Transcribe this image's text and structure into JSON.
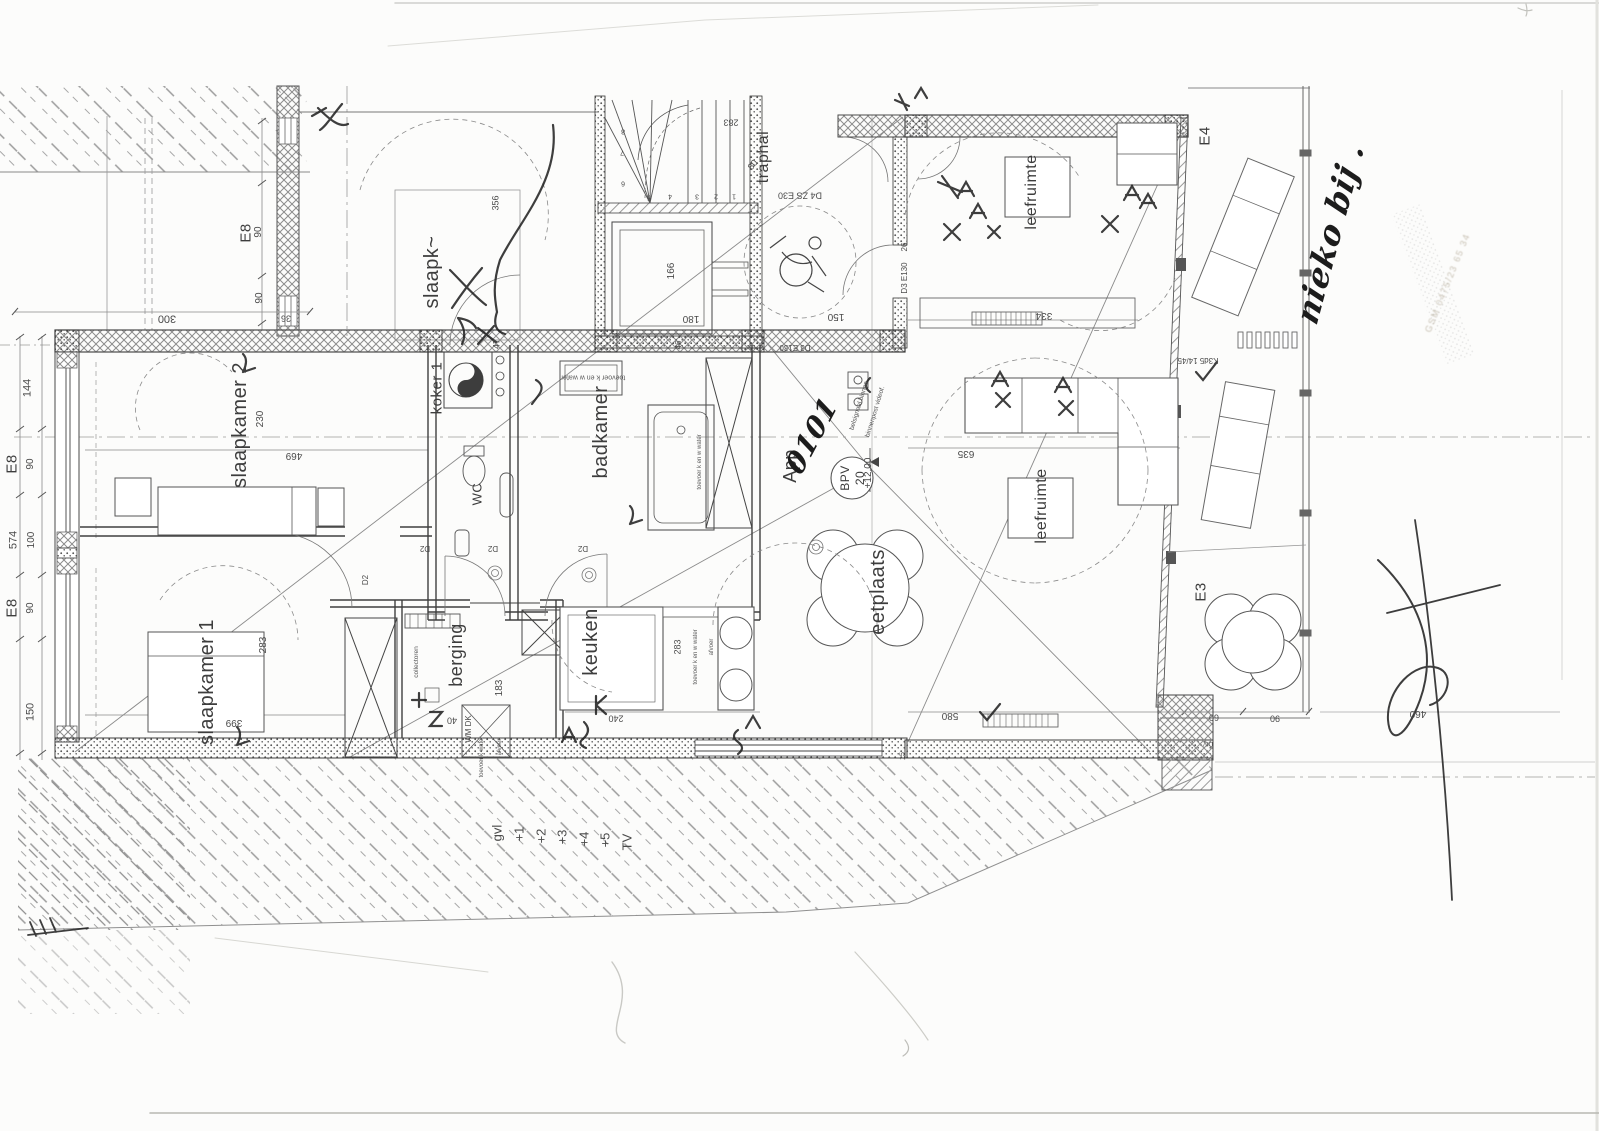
{
  "meta": {
    "document_kind_label": "scanned floor plan",
    "language": "Dutch",
    "ink_color": "#3d3d3d",
    "pen_color": "#1c1c1c",
    "paper_color": "#fcfcfb"
  },
  "apartment": {
    "unit_printed": "App",
    "unit_handwritten": "0101",
    "bpv_label": "BPV",
    "bpv_number": "20",
    "level_mark": "+12.00"
  },
  "labels": [
    {
      "n": "room-label-slaapk-partial",
      "text": "slaapk~",
      "x": 432,
      "y": 272,
      "rot": -90,
      "size": 20
    },
    {
      "n": "room-label-slaapkamer-2",
      "text": "slaapkamer 2",
      "x": 240,
      "y": 425,
      "rot": -90,
      "size": 20
    },
    {
      "n": "room-label-slaapkamer-1",
      "text": "slaapkamer 1",
      "x": 207,
      "y": 682,
      "rot": -90,
      "size": 20
    },
    {
      "n": "room-label-koker",
      "text": "koker 1",
      "x": 437,
      "y": 388,
      "rot": -90,
      "size": 15
    },
    {
      "n": "room-label-badkamer",
      "text": "badkamer",
      "x": 601,
      "y": 432,
      "rot": -90,
      "size": 20
    },
    {
      "n": "room-label-wc",
      "text": "WC",
      "x": 477,
      "y": 494,
      "rot": -90,
      "size": 13
    },
    {
      "n": "room-label-berging",
      "text": "berging",
      "x": 456,
      "y": 655,
      "rot": -90,
      "size": 18
    },
    {
      "n": "room-label-keuken",
      "text": "keuken",
      "x": 591,
      "y": 642,
      "rot": -90,
      "size": 20
    },
    {
      "n": "room-label-eetplaats",
      "text": "eetplaats",
      "x": 878,
      "y": 592,
      "rot": -90,
      "size": 20
    },
    {
      "n": "room-label-leefruimte-top",
      "text": "leefruimte",
      "x": 1032,
      "y": 192,
      "rot": -90,
      "size": 16
    },
    {
      "n": "room-label-leefruimte-mid",
      "text": "leefruimte",
      "x": 1042,
      "y": 506,
      "rot": -90,
      "size": 16
    },
    {
      "n": "room-label-traphal",
      "text": "traphal",
      "x": 764,
      "y": 157,
      "rot": -90,
      "size": 16
    },
    {
      "n": "unit-label-app",
      "text": "App",
      "x": 790,
      "y": 466,
      "rot": -90,
      "size": 18
    },
    {
      "n": "unit-number-handwritten",
      "text": "0101",
      "x": 812,
      "y": 436,
      "rot": -62,
      "size": 28,
      "cls": "hand"
    },
    {
      "n": "bpv-label",
      "text": "BPV",
      "x": 845,
      "y": 478,
      "rot": -90,
      "size": 12
    },
    {
      "n": "bpv-number",
      "text": "20",
      "x": 860,
      "y": 478,
      "rot": -90,
      "size": 12
    },
    {
      "n": "grid-label-e8-top",
      "text": "E8",
      "x": 246,
      "y": 233,
      "rot": -90,
      "size": 15
    },
    {
      "n": "grid-label-e8-left-1",
      "text": "E8",
      "x": 12,
      "y": 464,
      "rot": -90,
      "size": 15
    },
    {
      "n": "grid-label-e8-left-2",
      "text": "E8",
      "x": 12,
      "y": 608,
      "rot": -90,
      "size": 15
    },
    {
      "n": "grid-label-e4",
      "text": "E4",
      "x": 1205,
      "y": 136,
      "rot": -90,
      "size": 15
    },
    {
      "n": "grid-label-e3",
      "text": "E3",
      "x": 1201,
      "y": 592,
      "rot": -90,
      "size": 15
    },
    {
      "n": "dim-300",
      "text": "300",
      "x": 167,
      "y": 318,
      "rot": 180,
      "size": 11,
      "cls": "dim"
    },
    {
      "n": "dim-36",
      "text": "36",
      "x": 286,
      "y": 318,
      "rot": 180,
      "size": 9,
      "cls": "dim"
    },
    {
      "n": "dim-90-a",
      "text": "90",
      "x": 259,
      "y": 232,
      "rot": -90,
      "size": 10,
      "cls": "dim"
    },
    {
      "n": "dim-90-b",
      "text": "90",
      "x": 260,
      "y": 298,
      "rot": -90,
      "size": 10,
      "cls": "dim"
    },
    {
      "n": "dim-144",
      "text": "144",
      "x": 28,
      "y": 388,
      "rot": -90,
      "size": 11,
      "cls": "dim"
    },
    {
      "n": "dim-90-c",
      "text": "90",
      "x": 31,
      "y": 464,
      "rot": -90,
      "size": 10,
      "cls": "dim"
    },
    {
      "n": "dim-574",
      "text": "574",
      "x": 14,
      "y": 540,
      "rot": -90,
      "size": 11,
      "cls": "dim"
    },
    {
      "n": "dim-100",
      "text": "100",
      "x": 32,
      "y": 540,
      "rot": -90,
      "size": 10,
      "cls": "dim"
    },
    {
      "n": "dim-90-d",
      "text": "90",
      "x": 31,
      "y": 608,
      "rot": -90,
      "size": 10,
      "cls": "dim"
    },
    {
      "n": "dim-150-left",
      "text": "150",
      "x": 31,
      "y": 712,
      "rot": -90,
      "size": 11,
      "cls": "dim"
    },
    {
      "n": "dim-230",
      "text": "230",
      "x": 261,
      "y": 419,
      "rot": -90,
      "size": 10,
      "cls": "dim"
    },
    {
      "n": "dim-469",
      "text": "469",
      "x": 294,
      "y": 455,
      "rot": 180,
      "size": 10,
      "cls": "dim"
    },
    {
      "n": "dim-283-bk1",
      "text": "283",
      "x": 264,
      "y": 645,
      "rot": -90,
      "size": 10,
      "cls": "dim"
    },
    {
      "n": "dim-399",
      "text": "399",
      "x": 234,
      "y": 722,
      "rot": 180,
      "size": 10,
      "cls": "dim"
    },
    {
      "n": "dim-356",
      "text": "356",
      "x": 496,
      "y": 203,
      "rot": -90,
      "size": 9,
      "cls": "dim"
    },
    {
      "n": "dim-47",
      "text": "47",
      "x": 497,
      "y": 344,
      "rot": -90,
      "size": 9,
      "cls": "dim"
    },
    {
      "n": "dim-166",
      "text": "166",
      "x": 672,
      "y": 271,
      "rot": -90,
      "size": 10,
      "cls": "dim"
    },
    {
      "n": "dim-180",
      "text": "180",
      "x": 691,
      "y": 318,
      "rot": 180,
      "size": 10,
      "cls": "dim"
    },
    {
      "n": "dim-283-stair",
      "text": "283",
      "x": 731,
      "y": 122,
      "rot": 180,
      "size": 9,
      "cls": "dim"
    },
    {
      "n": "dim-80-stair",
      "text": "80",
      "x": 753,
      "y": 165,
      "rot": -50,
      "size": 9,
      "cls": "dim"
    },
    {
      "n": "door-code-d4-zs-e30",
      "text": "D4 ZS E30",
      "x": 800,
      "y": 195,
      "rot": 180,
      "size": 9,
      "cls": "dim"
    },
    {
      "n": "dim-150-hall",
      "text": "150",
      "x": 836,
      "y": 316,
      "rot": 180,
      "size": 10,
      "cls": "dim"
    },
    {
      "n": "dim-26",
      "text": "26",
      "x": 905,
      "y": 247,
      "rot": -90,
      "size": 8,
      "cls": "dim"
    },
    {
      "n": "door-code-d3-e130-a",
      "text": "D3 E130",
      "x": 905,
      "y": 278,
      "rot": -90,
      "size": 8,
      "cls": "dim"
    },
    {
      "n": "door-code-d3-e130-b",
      "text": "D3 E130",
      "x": 795,
      "y": 347,
      "rot": 180,
      "size": 8,
      "cls": "dim"
    },
    {
      "n": "dim-46",
      "text": "46",
      "x": 679,
      "y": 345,
      "rot": -90,
      "size": 8,
      "cls": "dim"
    },
    {
      "n": "level-mark",
      "text": "+12.00",
      "x": 869,
      "y": 473,
      "rot": -90,
      "size": 10,
      "cls": "dim"
    },
    {
      "n": "note-belsignaal",
      "text": "belsignaal binnen",
      "x": 860,
      "y": 406,
      "rot": -73,
      "size": 6.5,
      "cls": "tiny"
    },
    {
      "n": "note-binnenpost",
      "text": "binnenpost videof.",
      "x": 876,
      "y": 412,
      "rot": -73,
      "size": 6.5,
      "cls": "tiny"
    },
    {
      "n": "dim-635",
      "text": "635",
      "x": 966,
      "y": 453,
      "rot": 180,
      "size": 10,
      "cls": "dim"
    },
    {
      "n": "dim-334",
      "text": "334",
      "x": 1044,
      "y": 315,
      "rot": 180,
      "size": 10,
      "cls": "dim"
    },
    {
      "n": "dim-183",
      "text": "183",
      "x": 500,
      "y": 688,
      "rot": -90,
      "size": 10,
      "cls": "dim"
    },
    {
      "n": "dim-40",
      "text": "40",
      "x": 452,
      "y": 720,
      "rot": 180,
      "size": 9,
      "cls": "dim"
    },
    {
      "n": "equip-wm-dk",
      "text": "WM DK",
      "x": 469,
      "y": 729,
      "rot": -90,
      "size": 8,
      "cls": "dim"
    },
    {
      "n": "note-toevoer-k-water",
      "text": "toevoer k water",
      "x": 482,
      "y": 757,
      "rot": -90,
      "size": 6,
      "cls": "tiny"
    },
    {
      "n": "note-afvoer-berging",
      "text": "afvoer",
      "x": 500,
      "y": 747,
      "rot": -90,
      "size": 6,
      "cls": "tiny"
    },
    {
      "n": "note-collectoren",
      "text": "collectoren",
      "x": 417,
      "y": 662,
      "rot": -90,
      "size": 6.5,
      "cls": "tiny"
    },
    {
      "n": "dim-240",
      "text": "240",
      "x": 616,
      "y": 718,
      "rot": 180,
      "size": 9,
      "cls": "dim"
    },
    {
      "n": "dim-283-keuken",
      "text": "283",
      "x": 678,
      "y": 647,
      "rot": -90,
      "size": 9,
      "cls": "dim"
    },
    {
      "n": "note-toevoer-keuken",
      "text": "toevoer k en w water",
      "x": 696,
      "y": 657,
      "rot": -90,
      "size": 6,
      "cls": "tiny"
    },
    {
      "n": "note-afvoer-keuken",
      "text": "afvoer",
      "x": 712,
      "y": 647,
      "rot": -90,
      "size": 6,
      "cls": "tiny"
    },
    {
      "n": "note-toevoer-badkamer",
      "text": "toevoer k en w water",
      "x": 593,
      "y": 377,
      "rot": 180,
      "size": 7,
      "cls": "tiny"
    },
    {
      "n": "note-toevoer-bad",
      "text": "toevoer k en w water",
      "x": 700,
      "y": 462,
      "rot": -90,
      "size": 6,
      "cls": "tiny"
    },
    {
      "n": "dim-580",
      "text": "580",
      "x": 950,
      "y": 715,
      "rot": 180,
      "size": 10,
      "cls": "dim"
    },
    {
      "n": "dim-15",
      "text": "15",
      "x": 903,
      "y": 756,
      "rot": -90,
      "size": 7,
      "cls": "dim"
    },
    {
      "n": "note-div",
      "text": "DIV",
      "x": 1208,
      "y": 743,
      "rot": 180,
      "size": 6,
      "cls": "tiny"
    },
    {
      "n": "dim-60",
      "text": "60",
      "x": 1214,
      "y": 717,
      "rot": 180,
      "size": 9,
      "cls": "dim"
    },
    {
      "n": "dim-90-terrace",
      "text": "90",
      "x": 1275,
      "y": 718,
      "rot": 180,
      "size": 9,
      "cls": "dim"
    },
    {
      "n": "dim-460",
      "text": "460",
      "x": 1418,
      "y": 713,
      "rot": 180,
      "size": 10,
      "cls": "dim"
    },
    {
      "n": "note-k3d5",
      "text": "K3d5 14/45",
      "x": 1198,
      "y": 360,
      "rot": 180,
      "size": 8,
      "cls": "dim"
    },
    {
      "n": "door-code-d2-a",
      "text": "D2",
      "x": 425,
      "y": 548,
      "rot": 180,
      "size": 8,
      "cls": "dim"
    },
    {
      "n": "door-code-d2-b",
      "text": "D2",
      "x": 493,
      "y": 548,
      "rot": 180,
      "size": 8,
      "cls": "dim"
    },
    {
      "n": "door-code-d2-c",
      "text": "D2",
      "x": 583,
      "y": 548,
      "rot": 180,
      "size": 8,
      "cls": "dim"
    },
    {
      "n": "door-code-d2-d",
      "text": "D2",
      "x": 366,
      "y": 580,
      "rot": -90,
      "size": 8,
      "cls": "dim"
    },
    {
      "n": "ground-gvl",
      "text": "gvl",
      "x": 497,
      "y": 833,
      "rot": -90,
      "size": 13,
      "cls": "dim"
    },
    {
      "n": "ground-p1",
      "text": "+1",
      "x": 519,
      "y": 834,
      "rot": -90,
      "size": 13,
      "cls": "dim"
    },
    {
      "n": "ground-p2",
      "text": "+2",
      "x": 541,
      "y": 836,
      "rot": -90,
      "size": 13,
      "cls": "dim"
    },
    {
      "n": "ground-p3",
      "text": "+3",
      "x": 562,
      "y": 837,
      "rot": -90,
      "size": 13,
      "cls": "dim"
    },
    {
      "n": "ground-p4",
      "text": "+4",
      "x": 584,
      "y": 839,
      "rot": -90,
      "size": 13,
      "cls": "dim"
    },
    {
      "n": "ground-p5",
      "text": "+5",
      "x": 605,
      "y": 840,
      "rot": -90,
      "size": 13,
      "cls": "dim"
    },
    {
      "n": "ground-tv",
      "text": "TV",
      "x": 627,
      "y": 842,
      "rot": -90,
      "size": 13,
      "cls": "dim"
    },
    {
      "n": "stair-tread-8",
      "text": "8",
      "x": 623,
      "y": 131,
      "rot": 180,
      "size": 7,
      "cls": "dim"
    },
    {
      "n": "stair-tread-7",
      "text": "7",
      "x": 622,
      "y": 152,
      "rot": 180,
      "size": 7,
      "cls": "dim"
    },
    {
      "n": "stair-tread-6",
      "text": "6",
      "x": 623,
      "y": 183,
      "rot": 180,
      "size": 7,
      "cls": "dim"
    },
    {
      "n": "stair-tread-5",
      "text": "5",
      "x": 649,
      "y": 197,
      "rot": 180,
      "size": 7,
      "cls": "dim"
    },
    {
      "n": "stair-tread-4",
      "text": "4",
      "x": 670,
      "y": 196,
      "rot": 180,
      "size": 7,
      "cls": "dim"
    },
    {
      "n": "stair-tread-3",
      "text": "3",
      "x": 697,
      "y": 196,
      "rot": 180,
      "size": 7,
      "cls": "dim"
    },
    {
      "n": "stair-tread-2",
      "text": "2",
      "x": 716,
      "y": 196,
      "rot": 180,
      "size": 7,
      "cls": "dim"
    },
    {
      "n": "stair-tread-1",
      "text": "1",
      "x": 734,
      "y": 196,
      "rot": 180,
      "size": 7,
      "cls": "dim"
    },
    {
      "n": "handwritten-note",
      "text": "nieko bij .",
      "x": 1330,
      "y": 233,
      "rot": -75,
      "size": 32,
      "cls": "hand"
    },
    {
      "n": "stamp-gsm-line",
      "text": "GSM 0475/23 65 34",
      "x": 1448,
      "y": 283,
      "rot": -68,
      "size": 9,
      "cls": "faint"
    }
  ]
}
